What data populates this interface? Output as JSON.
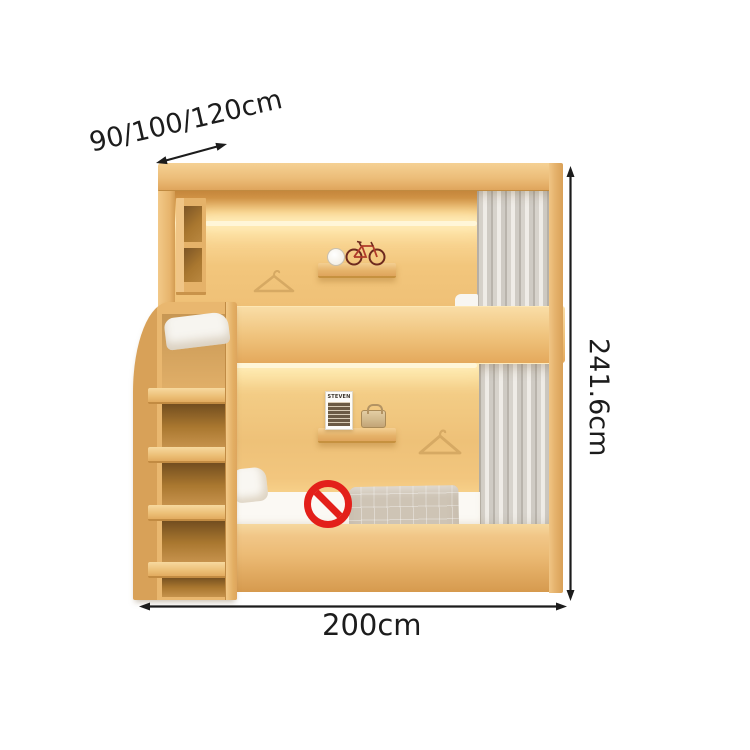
{
  "annotations": {
    "depth_label": "90/100/120cm",
    "height_label": "241.6cm",
    "width_label": "200cm"
  },
  "decor": {
    "poster_title": "STEVEN"
  },
  "icons": {
    "prohibition": "no-sitting-prohibition-icon",
    "bicycle": "bicycle-model",
    "clock": "alarm-clock",
    "hanger": "clothes-hanger"
  },
  "colors": {
    "wood_light": "#f2c98c",
    "wood_mid": "#ecb977",
    "wood_dark": "#d69a4e",
    "wall_glow": "#ffeabc",
    "led": "#fff6d8",
    "curtain": "#dedad3",
    "bedding_white": "#faf8f3",
    "blanket": "#cec4b5",
    "prohibition_red": "#e3201a",
    "annotation_ink": "#1c1c1c"
  }
}
